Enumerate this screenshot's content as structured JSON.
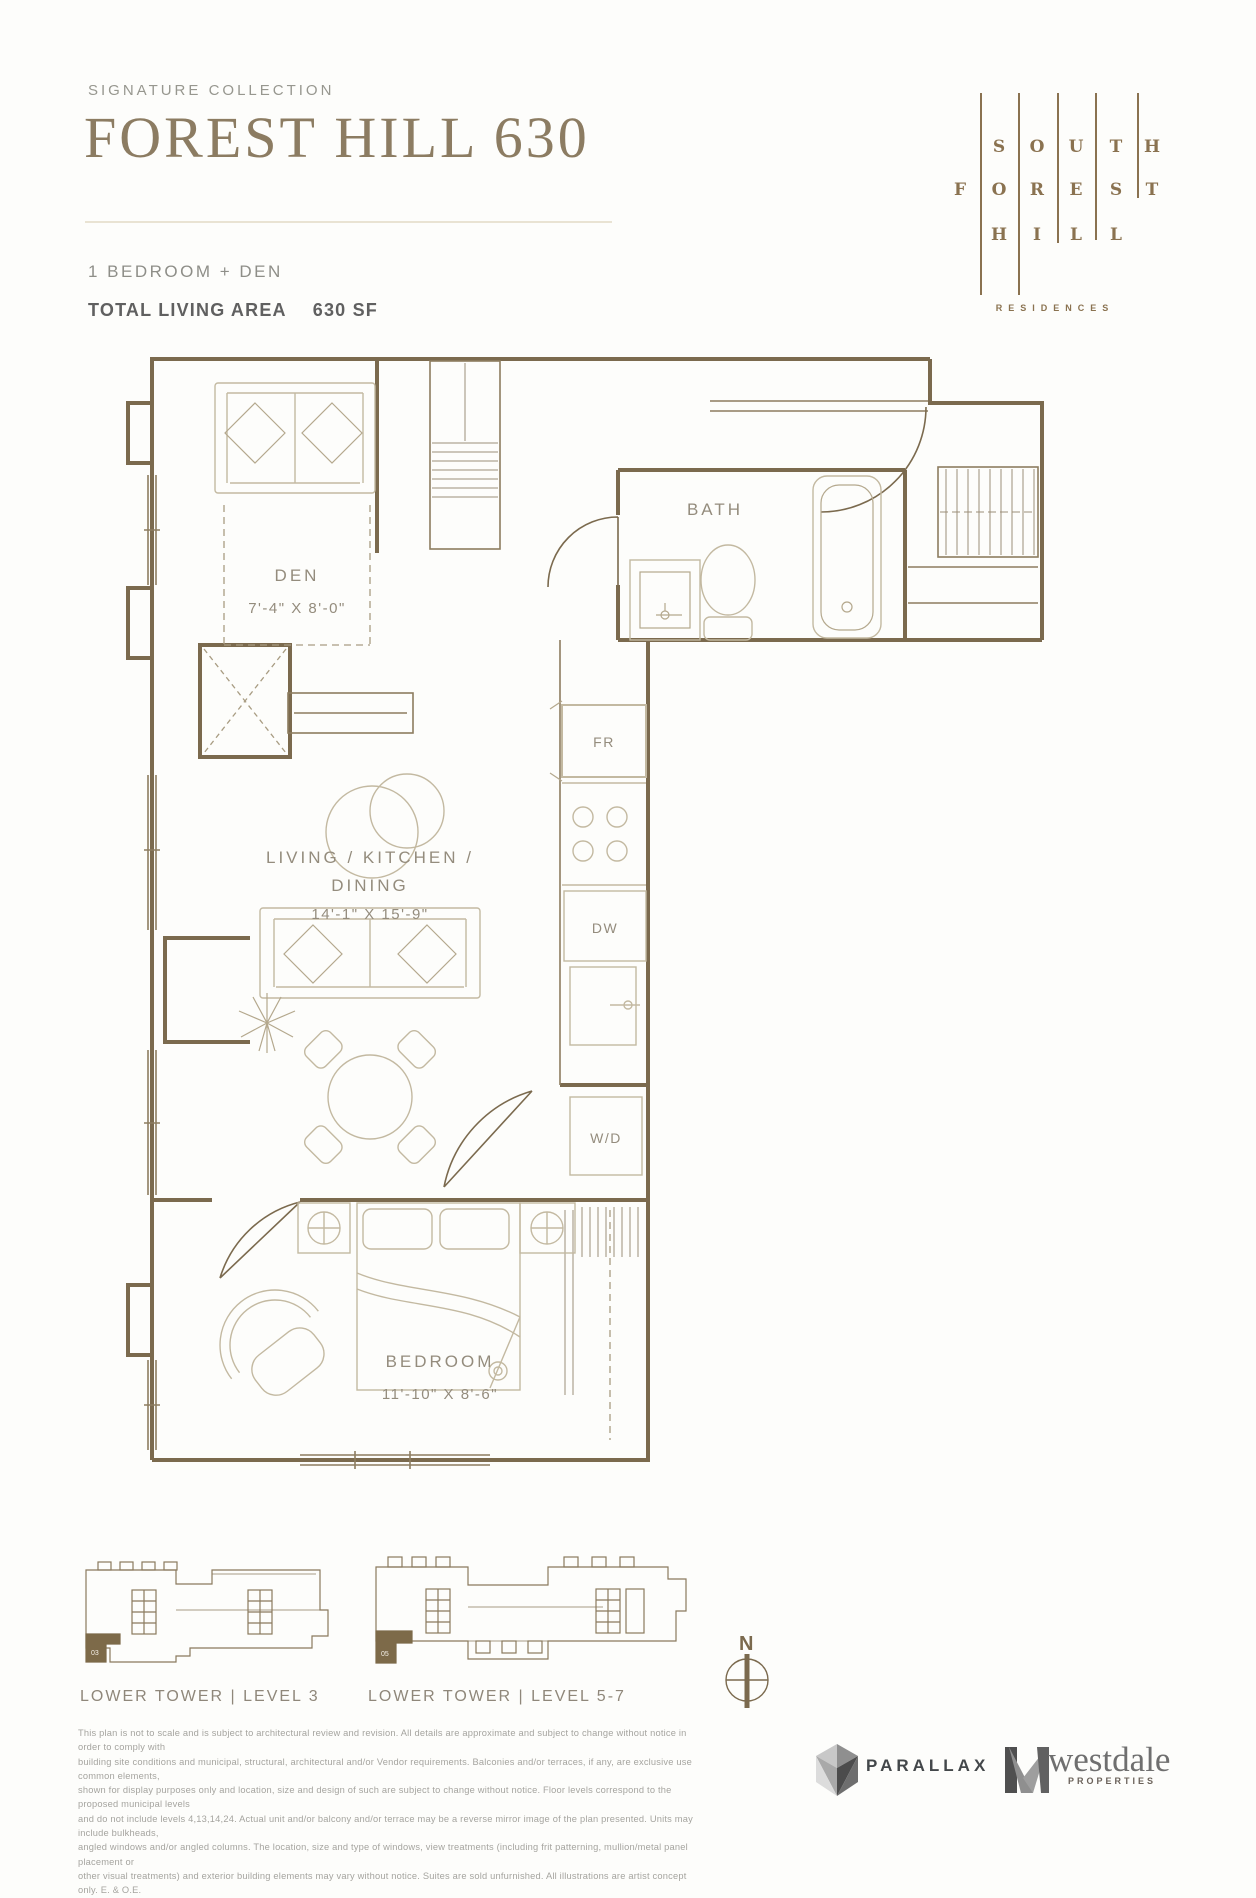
{
  "header": {
    "collection": "SIGNATURE COLLECTION",
    "title": "FOREST HILL 630",
    "unit_type": "1 BEDROOM + DEN",
    "area_label": "TOTAL LIVING AREA",
    "area_value": "630 SF"
  },
  "logo": {
    "rows": [
      "SOUTH",
      "FOREST",
      "HILL"
    ],
    "residences": "RESIDENCES",
    "color": "#8a7250"
  },
  "floorplan": {
    "labels": {
      "den": "DEN",
      "den_dims": "7'-4\" X 8'-0\"",
      "bath": "BATH",
      "living1": "LIVING / KITCHEN /",
      "living2": "DINING",
      "living_dims": "14'-1\" X 15'-9\"",
      "bedroom": "BEDROOM",
      "bedroom_dims": "11'-10\" X 8'-6\"",
      "fridge": "FR",
      "dishwasher": "DW",
      "washer_dryer": "W/D"
    },
    "colors": {
      "wall": "#7b6a4e",
      "furniture": "#c3b9a1",
      "label": "#948c7d"
    }
  },
  "keyplans": [
    {
      "label": "LOWER TOWER | LEVEL 3",
      "unit": "03"
    },
    {
      "label": "LOWER TOWER | LEVEL 5-7",
      "unit": "05"
    }
  ],
  "compass": {
    "label": "N"
  },
  "disclaimer": {
    "lines": [
      "This plan is not to scale and is subject to architectural review and revision. All details are approximate and subject to change without notice in order to comply with",
      "building site conditions and municipal, structural, architectural and/or Vendor requirements. Balconies and/or terraces, if any, are exclusive use common elements,",
      "shown for display purposes only and location, size and design of such are subject to change without notice. Floor levels correspond to the proposed municipal levels",
      "and do not include levels 4,13,14,24. Actual unit and/or balcony and/or terrace may be a reverse mirror image of the plan presented. Units may include bulkheads,",
      "angled windows and/or angled columns. The location, size and type of windows, view treatments (including frit patterning, mullion/metal panel placement or",
      "other visual treatments) and exterior building elements may vary without notice. Suites are sold unfurnished. All illustrations are artist concept only. E. & O.E."
    ]
  },
  "footer": {
    "parallax": "PARALLAX",
    "westdale": "westdale",
    "westdale_sub": "PROPERTIES"
  }
}
